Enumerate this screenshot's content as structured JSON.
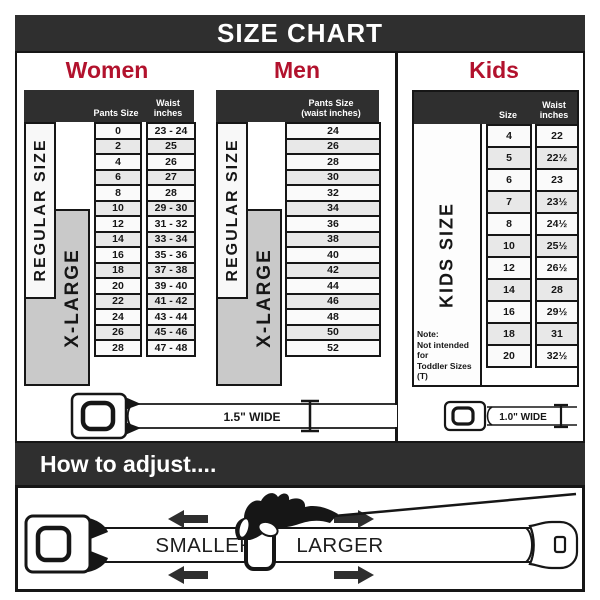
{
  "title": "SIZE CHART",
  "colors": {
    "accent_red": "#b2122d",
    "bar_dark": "#2f2f2f",
    "xlarge_gray": "#c9c9c9",
    "row_alt_gray": "#e8e8e8"
  },
  "women": {
    "heading": "Women",
    "col1_header": "Pants Size",
    "col2_header": "Waist inches",
    "regular_label": "REGULAR SIZE",
    "xlarge_label": "X-LARGE",
    "rows": [
      {
        "size": "0",
        "waist": "23 - 24"
      },
      {
        "size": "2",
        "waist": "25"
      },
      {
        "size": "4",
        "waist": "26"
      },
      {
        "size": "6",
        "waist": "27"
      },
      {
        "size": "8",
        "waist": "28"
      },
      {
        "size": "10",
        "waist": "29 - 30"
      },
      {
        "size": "12",
        "waist": "31 - 32"
      },
      {
        "size": "14",
        "waist": "33 - 34"
      },
      {
        "size": "16",
        "waist": "35 - 36"
      },
      {
        "size": "18",
        "waist": "37 - 38"
      },
      {
        "size": "20",
        "waist": "39 - 40"
      },
      {
        "size": "22",
        "waist": "41 - 42"
      },
      {
        "size": "24",
        "waist": "43 - 44"
      },
      {
        "size": "26",
        "waist": "45 - 46"
      },
      {
        "size": "28",
        "waist": "47 - 48"
      }
    ]
  },
  "men": {
    "heading": "Men",
    "col_header": "Pants Size (waist inches)",
    "regular_label": "REGULAR SIZE",
    "xlarge_label": "X-LARGE",
    "rows": [
      "24",
      "26",
      "28",
      "30",
      "32",
      "34",
      "36",
      "38",
      "40",
      "42",
      "44",
      "46",
      "48",
      "50",
      "52"
    ]
  },
  "kids": {
    "heading": "Kids",
    "col1_header": "Size",
    "col2_header": "Waist inches",
    "side_label": "KIDS SIZE",
    "note": "Note:\nNot intended for\nToddler Sizes (T)",
    "rows": [
      {
        "size": "4",
        "waist": "22"
      },
      {
        "size": "5",
        "waist": "22½"
      },
      {
        "size": "6",
        "waist": "23"
      },
      {
        "size": "7",
        "waist": "23½"
      },
      {
        "size": "8",
        "waist": "24½"
      },
      {
        "size": "10",
        "waist": "25½"
      },
      {
        "size": "12",
        "waist": "26½"
      },
      {
        "size": "14",
        "waist": "28"
      },
      {
        "size": "16",
        "waist": "29½"
      },
      {
        "size": "18",
        "waist": "31"
      },
      {
        "size": "20",
        "waist": "32½"
      }
    ]
  },
  "belts": {
    "women_men_label": "1.5\" WIDE",
    "kids_label": "1.0\" WIDE"
  },
  "adjust": {
    "title": "How to adjust....",
    "smaller_label": "SMALLER",
    "larger_label": "LARGER"
  }
}
